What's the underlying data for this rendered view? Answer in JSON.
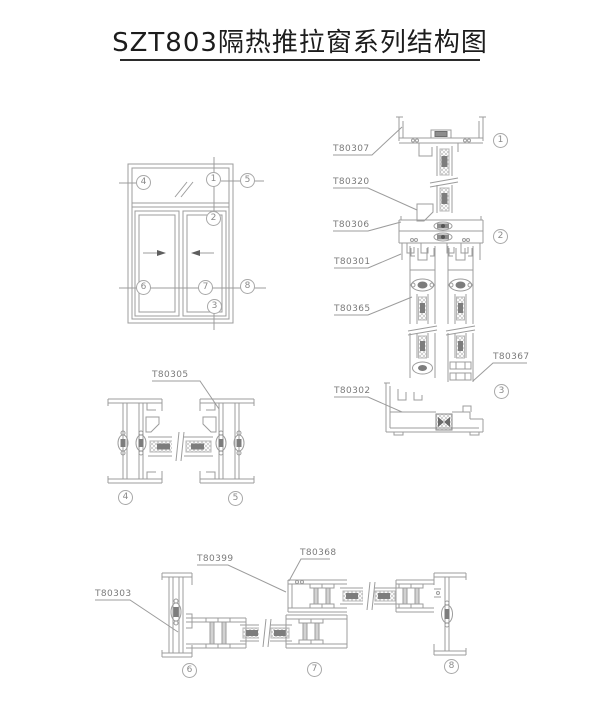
{
  "title": "SZT803隔热推拉窗系列结构图",
  "colors": {
    "line": "#9c9c9c",
    "dark_fill": "#6e6e6e",
    "label_text": "#7b7b7b",
    "title_text": "#1c1c1c"
  },
  "elevation": {
    "callouts": {
      "c1": "1",
      "c2": "2",
      "c3": "3",
      "c4": "4",
      "c5": "5",
      "c6": "6",
      "c7": "7",
      "c8": "8"
    }
  },
  "vertical_section": {
    "labels": {
      "t80307": "T80307",
      "t80320": "T80320",
      "t80306": "T80306",
      "t80301": "T80301",
      "t80365": "T80365",
      "t80367": "T80367",
      "t80302": "T80302"
    },
    "callouts": {
      "c1": "1",
      "c2": "2",
      "c3": "3"
    }
  },
  "mid_section": {
    "labels": {
      "t80305": "T80305"
    },
    "callouts": {
      "c4": "4",
      "c5": "5"
    }
  },
  "bottom_section": {
    "labels": {
      "t80303": "T80303",
      "t80399": "T80399",
      "t80368": "T80368"
    },
    "callouts": {
      "c6": "6",
      "c7": "7",
      "c8": "8"
    }
  }
}
